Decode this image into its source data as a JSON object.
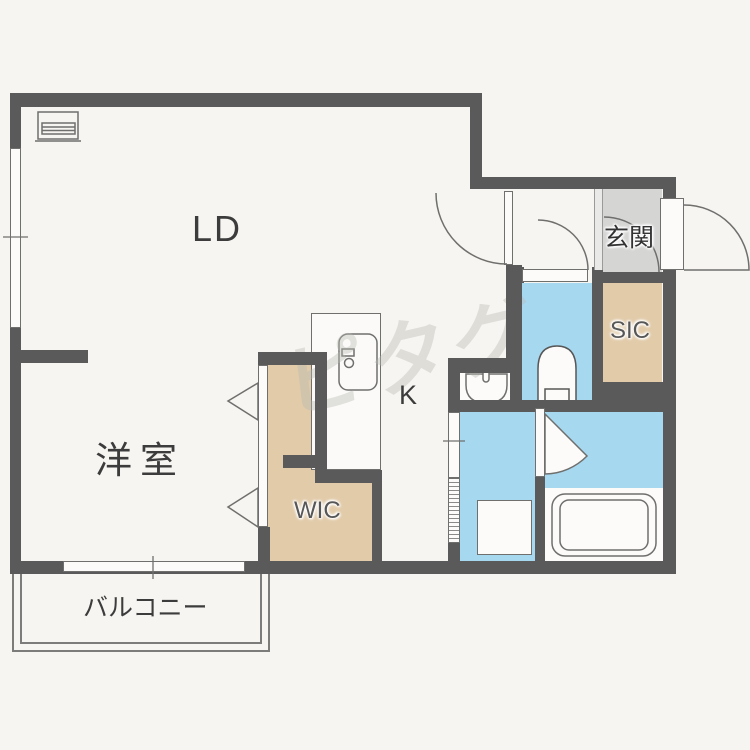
{
  "plan": {
    "type": "floorplan",
    "rooms": {
      "ld": "LD",
      "western": "洋室",
      "kitchen": "K",
      "wic": "WIC",
      "sic": "SIC",
      "entrance": "玄関",
      "balcony": "バルコニー"
    },
    "watermark": "ピタグ",
    "colors": {
      "background": "#f7f5f1",
      "wall": "#5a5a5a",
      "water": "#a6d8f0",
      "closet": "#e2cba9",
      "entrance_floor": "#d5d5d4",
      "outline": "#6f6f6e",
      "label": "#3c3c3c"
    }
  }
}
